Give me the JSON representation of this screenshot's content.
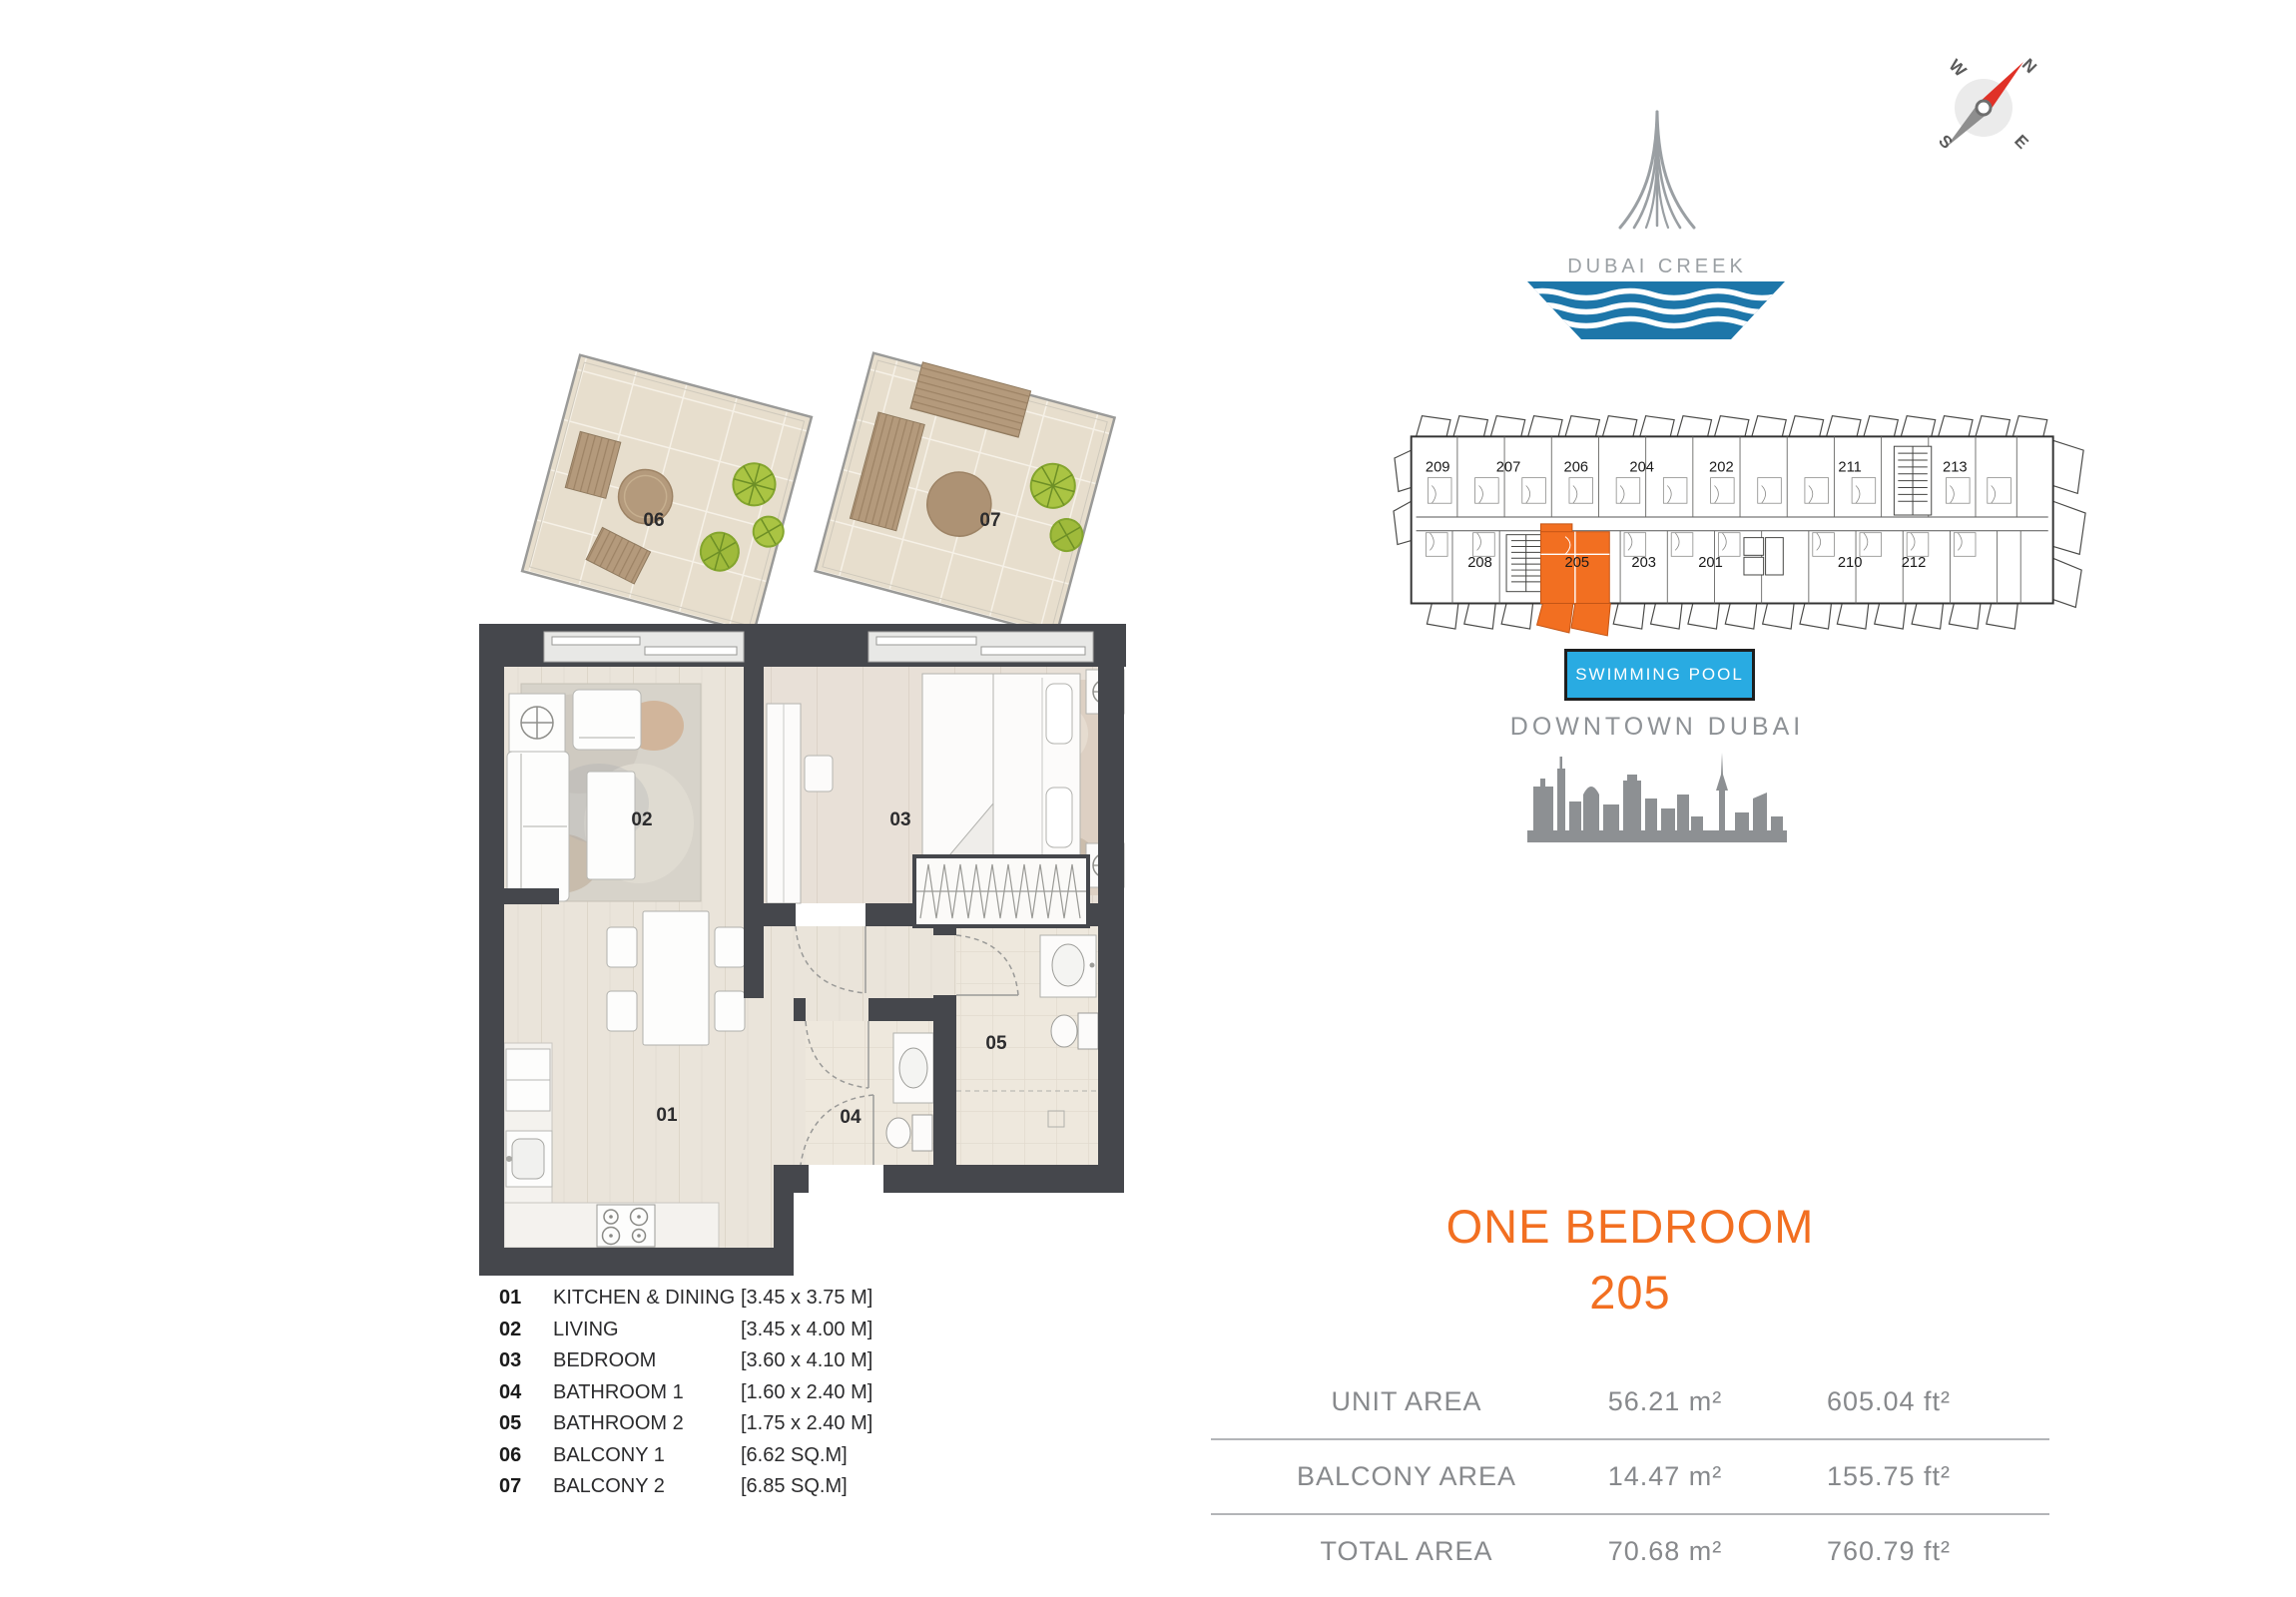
{
  "page": {
    "background": "#FFFFFF"
  },
  "compass": {
    "letters": {
      "n": "N",
      "e": "E",
      "s": "S",
      "w": "W"
    },
    "needle_red": "#E03127",
    "needle_gray": "#8E8E8E"
  },
  "logo": {
    "title": "DUBAI CREEK",
    "water_blue": "#1D76A9",
    "tower_gray": "#9A9FA3"
  },
  "siteplan": {
    "top_units": [
      {
        "label": "209"
      },
      {
        "label": "207"
      },
      {
        "label": "206"
      },
      {
        "label": "204"
      },
      {
        "label": "202"
      },
      {
        "label": "211"
      },
      {
        "label": "213"
      }
    ],
    "bottom_units": [
      {
        "label": "208"
      },
      {
        "label": "205"
      },
      {
        "label": "203"
      },
      {
        "label": "201"
      },
      {
        "label": "210"
      },
      {
        "label": "212"
      }
    ],
    "highlighted_unit": "205",
    "highlight_color": "#F26F21"
  },
  "pool": {
    "label": "SWIMMING POOL",
    "color": "#29ABE2"
  },
  "downtown": {
    "label": "DOWNTOWN DUBAI",
    "skyline_color": "#8D9093"
  },
  "plan": {
    "rooms": [
      {
        "num": "01"
      },
      {
        "num": "02"
      },
      {
        "num": "03"
      },
      {
        "num": "04"
      },
      {
        "num": "05"
      },
      {
        "num": "06"
      },
      {
        "num": "07"
      }
    ]
  },
  "legend": {
    "items": [
      {
        "num": "01",
        "name": "KITCHEN & DINING",
        "dims": "[3.45 x 3.75 M]"
      },
      {
        "num": "02",
        "name": "LIVING",
        "dims": "[3.45 x 4.00 M]"
      },
      {
        "num": "03",
        "name": "BEDROOM",
        "dims": "[3.60 x 4.10 M]"
      },
      {
        "num": "04",
        "name": "BATHROOM 1",
        "dims": "[1.60 x 2.40 M]"
      },
      {
        "num": "05",
        "name": "BATHROOM 2",
        "dims": "[1.75 x 2.40 M]"
      },
      {
        "num": "06",
        "name": "BALCONY 1",
        "dims": "[6.62 SQ.M]"
      },
      {
        "num": "07",
        "name": "BALCONY 2",
        "dims": "[6.85 SQ.M]"
      }
    ]
  },
  "unit": {
    "type": "ONE BEDROOM",
    "number": "205",
    "accent": "#F26F21"
  },
  "areas": {
    "rows": [
      {
        "label": "UNIT AREA",
        "m2": "56.21 m²",
        "ft2": "605.04 ft²"
      },
      {
        "label": "BALCONY AREA",
        "m2": "14.47 m²",
        "ft2": "155.75 ft²"
      },
      {
        "label": "TOTAL AREA",
        "m2": "70.68 m²",
        "ft2": "760.79 ft²"
      }
    ]
  }
}
